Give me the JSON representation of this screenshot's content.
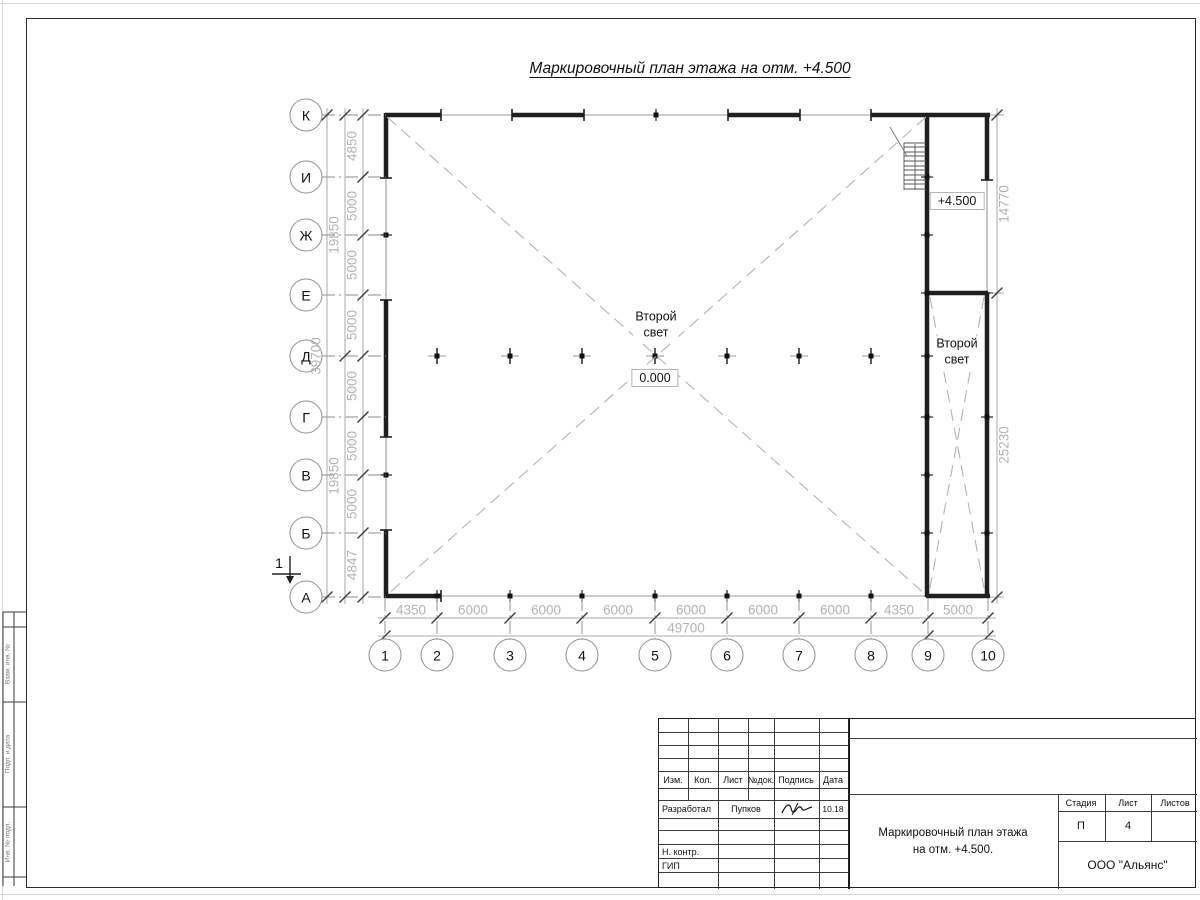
{
  "sheet": {
    "drawing_title": "Маркировочный план этажа на отм. +4.500"
  },
  "plan": {
    "axes": {
      "rows": [
        "К",
        "И",
        "Ж",
        "Е",
        "Д",
        "Г",
        "В",
        "Б",
        "А"
      ],
      "cols": [
        "1",
        "2",
        "3",
        "4",
        "5",
        "6",
        "7",
        "8",
        "9",
        "10"
      ]
    },
    "labels": {
      "second_light_line1": "Второй",
      "second_light_line2": "свет",
      "level_zero": "0.000",
      "level_bay": "+4.500",
      "section_mark": "1"
    },
    "dims": {
      "left": [
        "4850",
        "5000",
        "5000",
        "5000",
        "5000",
        "5000",
        "5000",
        "4847"
      ],
      "left_groups": [
        "19850",
        "19850"
      ],
      "left_total": "39700",
      "bottom": [
        "4350",
        "6000",
        "6000",
        "6000",
        "6000",
        "6000",
        "6000",
        "4350",
        "5000"
      ],
      "bottom_total": "49700",
      "right": [
        "14770",
        "25230"
      ]
    }
  },
  "title_block": {
    "header_cols": [
      "Изм.",
      "Кол.",
      "Лист",
      "№док.",
      "Подпись",
      "Дата"
    ],
    "developed_label": "Разработал",
    "developed_name": "Пупков",
    "developed_date": "10.18",
    "ncontrol_label": "Н. контр.",
    "gip_label": "ГИП",
    "stage_cols": [
      "Стадия",
      "Лист",
      "Листов"
    ],
    "stage": "П",
    "sheet_no": "4",
    "doc_title_line1": "Маркировочный план этажа",
    "doc_title_line2": "на отм. +4.500.",
    "company": "ООО \"Альянс\""
  },
  "margin": {
    "labels": [
      "Взам. инв. №",
      "Подп. и дата",
      "Инв. № подл."
    ]
  }
}
